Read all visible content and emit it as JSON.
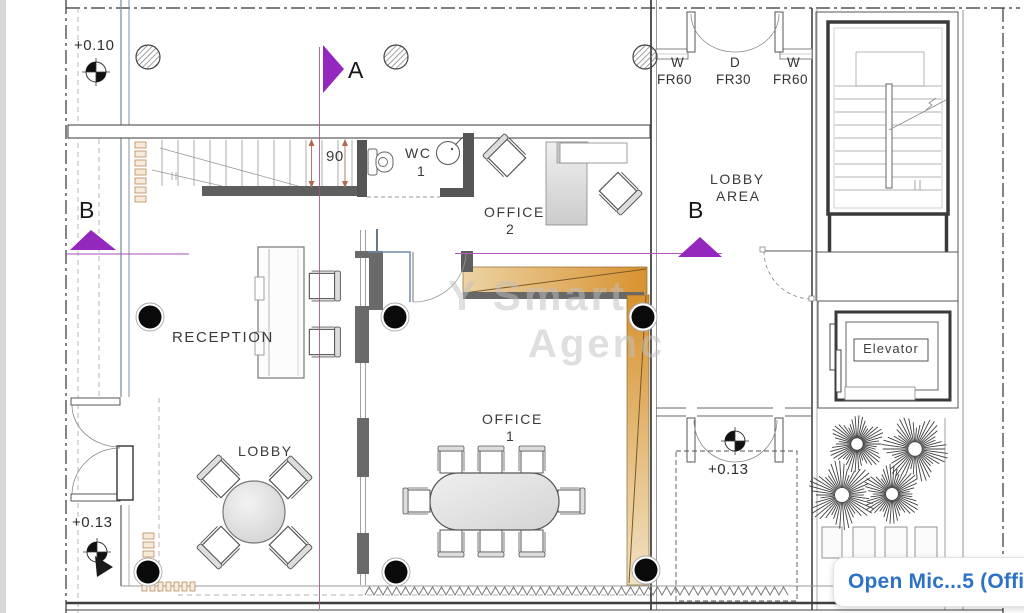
{
  "plan": {
    "markers": {
      "section_a": "A",
      "section_b_left": "B",
      "section_b_right": "B"
    },
    "levels": {
      "upper_left": "+0.10",
      "lower_left": "+0.13",
      "courtyard": "+0.13"
    },
    "dimensions": {
      "stair_width": "90"
    },
    "rooms": {
      "wc_name": "WC",
      "wc_number": "1",
      "office2_name": "OFFICE",
      "office2_number": "2",
      "office1_name": "OFFICE",
      "office1_number": "1",
      "reception": "RECEPTION",
      "lobby": "LOBBY",
      "lobby_area_line1": "LOBBY",
      "lobby_area_line2": "AREA",
      "elevator": "Elevator"
    },
    "fire_ratings": [
      {
        "opening": "W",
        "rating": "FR60"
      },
      {
        "opening": "D",
        "rating": "FR30"
      },
      {
        "opening": "W",
        "rating": "FR60"
      }
    ],
    "watermark_line1": "Y Smart",
    "watermark_line2": "Agenc"
  },
  "overlay": {
    "title": "Open Mic...5 (Office)"
  },
  "colors": {
    "section_marker": "#9427bd",
    "ramp": "#d8922f",
    "overlay_text": "#2e72c6"
  }
}
